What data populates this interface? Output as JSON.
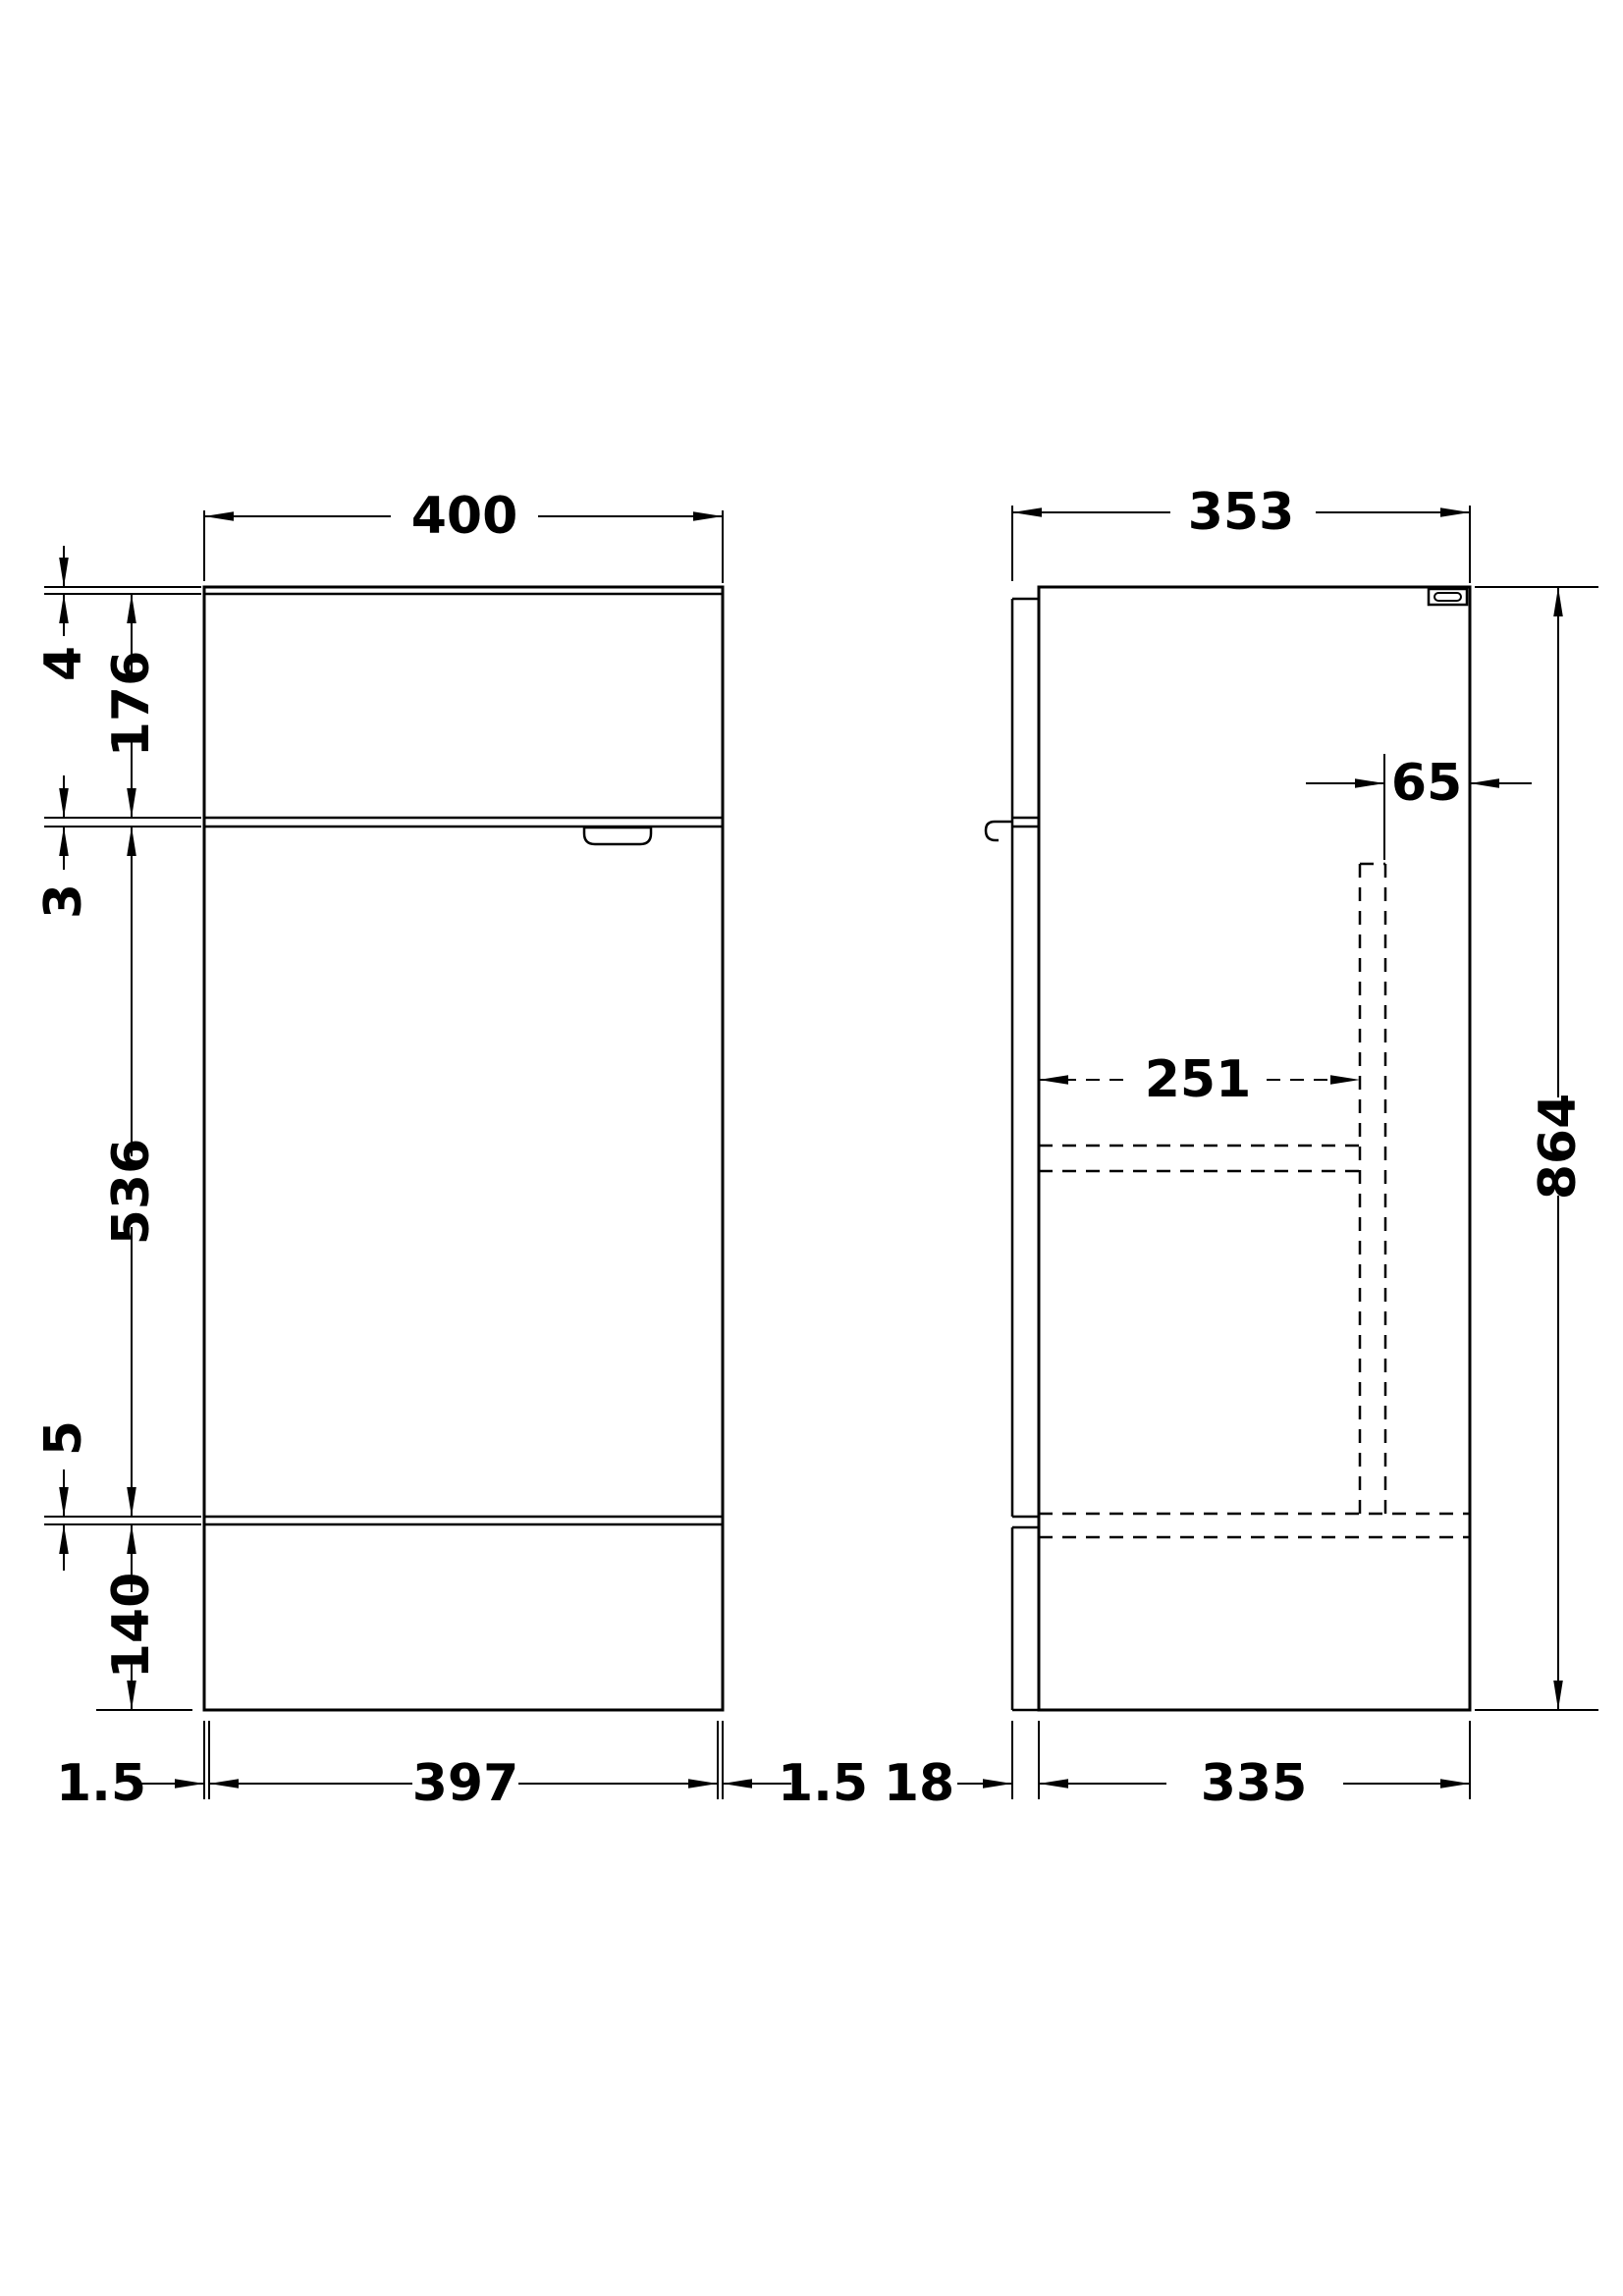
{
  "drawing": {
    "front_view": {
      "width_top": "400",
      "top_thickness": "4",
      "upper_section_height": "176",
      "divider_thickness": "3",
      "door_height": "536",
      "bottom_gap": "5",
      "plinth_height": "140",
      "bottom_left_gap": "1.5",
      "door_width": "397",
      "bottom_right_gap": "1.5"
    },
    "side_view": {
      "depth": "353",
      "service_gap": "65",
      "internal_depth": "251",
      "height": "864",
      "panel_thickness": "18",
      "carcass_depth": "335"
    }
  },
  "colors": {
    "line": "#000000",
    "background": "#ffffff"
  }
}
